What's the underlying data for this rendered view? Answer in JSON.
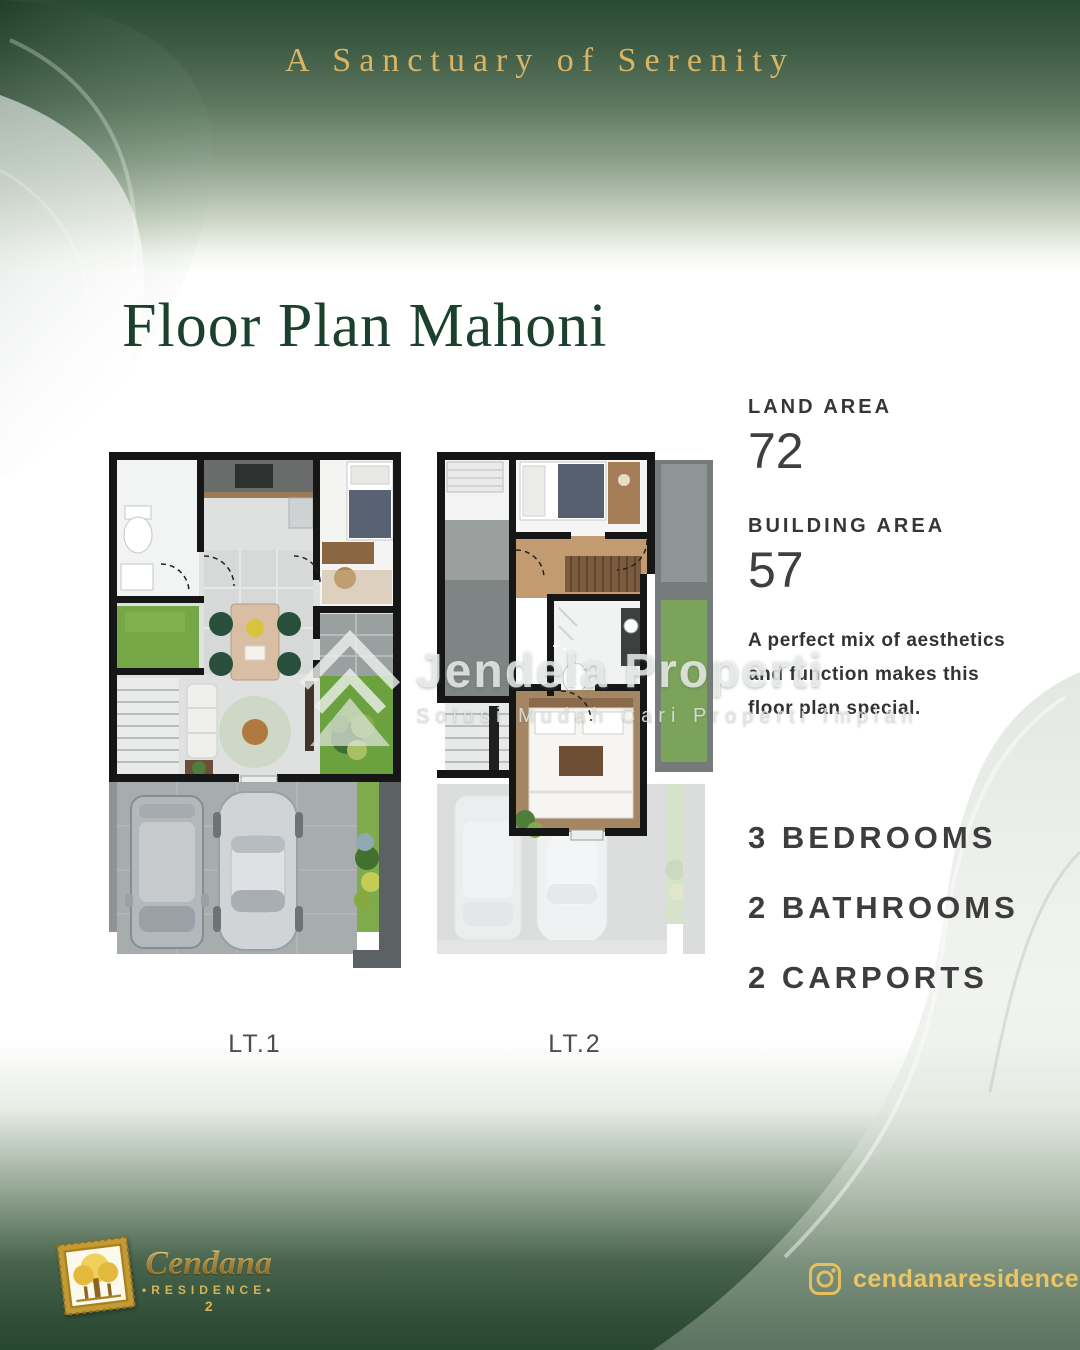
{
  "header": {
    "tagline": "A Sanctuary of Serenity"
  },
  "title": "Floor Plan Mahoni",
  "specs": {
    "land_area": {
      "label": "LAND AREA",
      "value": "72"
    },
    "building_area": {
      "label": "BUILDING AREA",
      "value": "57"
    },
    "description_lines": [
      "A perfect mix of aesthetics",
      "and function makes this",
      "floor plan special."
    ],
    "features": [
      "3 BEDROOMS",
      "2 BATHROOMS",
      "2 CARPORTS"
    ]
  },
  "floorplans": {
    "left_label": "LT.1",
    "right_label": "LT.2"
  },
  "watermark": {
    "logo_icon": "jendela-properti-diamond-icon",
    "name": "Jendela Properti",
    "tagline": "Solusi Mudah Cari Properti Impian"
  },
  "footer": {
    "brand": {
      "logo_icon": "cendana-tree-stamp-icon",
      "name": "Cendana",
      "type": "•RESIDENCE•",
      "number": "2"
    },
    "instagram": {
      "icon": "instagram-icon",
      "handle": "cendanaresidence2"
    }
  },
  "colors": {
    "gold": "#d9b465",
    "title_green": "#1b402e",
    "band_green_top": "#2a4b32",
    "band_green_bottom": "#284731",
    "text_dark": "#3b3b3b",
    "grass_green": "#6fa342",
    "wall_black": "#161616"
  }
}
